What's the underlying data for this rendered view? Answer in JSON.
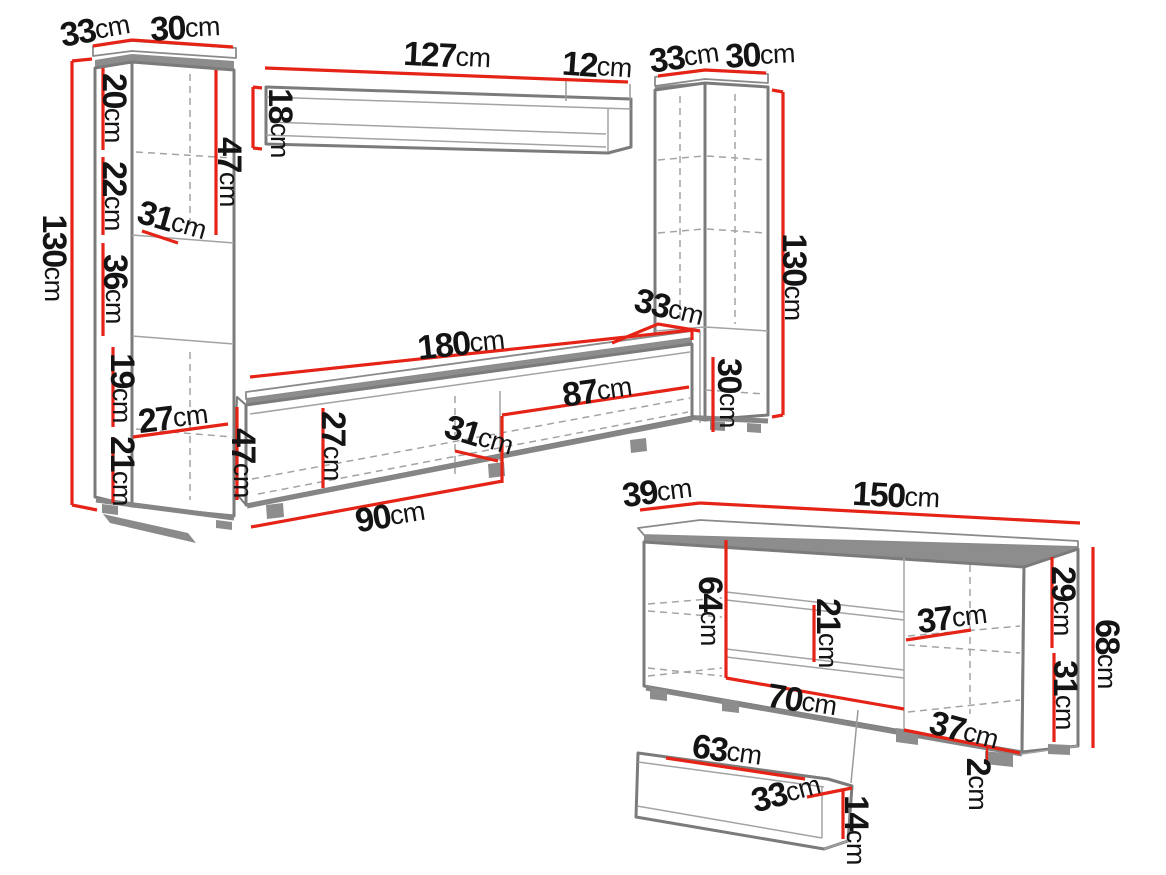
{
  "unit": "cm",
  "colors": {
    "dimension_line": "#e52317",
    "furniture_outline": "#7b7b7b",
    "label_text": "#141414",
    "background": "#ffffff"
  },
  "figure": {
    "type": "furniture-dimension-diagram",
    "left_cabinet": {
      "top_depth": "33",
      "top_width": "30",
      "height": "130",
      "shelf_sections": [
        "20",
        "22",
        "36",
        "19",
        "21"
      ],
      "niche_width": "31",
      "bottom_inner_width": "27",
      "upper_door_height": "47"
    },
    "wall_shelf": {
      "length": "127",
      "end_depth": "12",
      "height": "18"
    },
    "right_cabinet": {
      "top_depth": "33",
      "top_width": "30",
      "height": "130",
      "lower_depth": "33",
      "lower_height": "30"
    },
    "tv_stand": {
      "length": "180",
      "right_flap_width": "87",
      "front_height": "27",
      "inner_depth": "31",
      "left_flap_width": "90",
      "left_height": "47"
    },
    "sideboard": {
      "depth": "39",
      "length": "150",
      "inner_height": "64",
      "drawer_height": "21",
      "upper_shelf_depth": "37",
      "right_upper_height": "29",
      "right_lower_height": "31",
      "height": "68",
      "left_door_width": "70",
      "lower_shelf_depth": "37",
      "foot_height": "2"
    },
    "insert_shelf": {
      "length": "63",
      "depth": "33",
      "height": "14"
    }
  }
}
